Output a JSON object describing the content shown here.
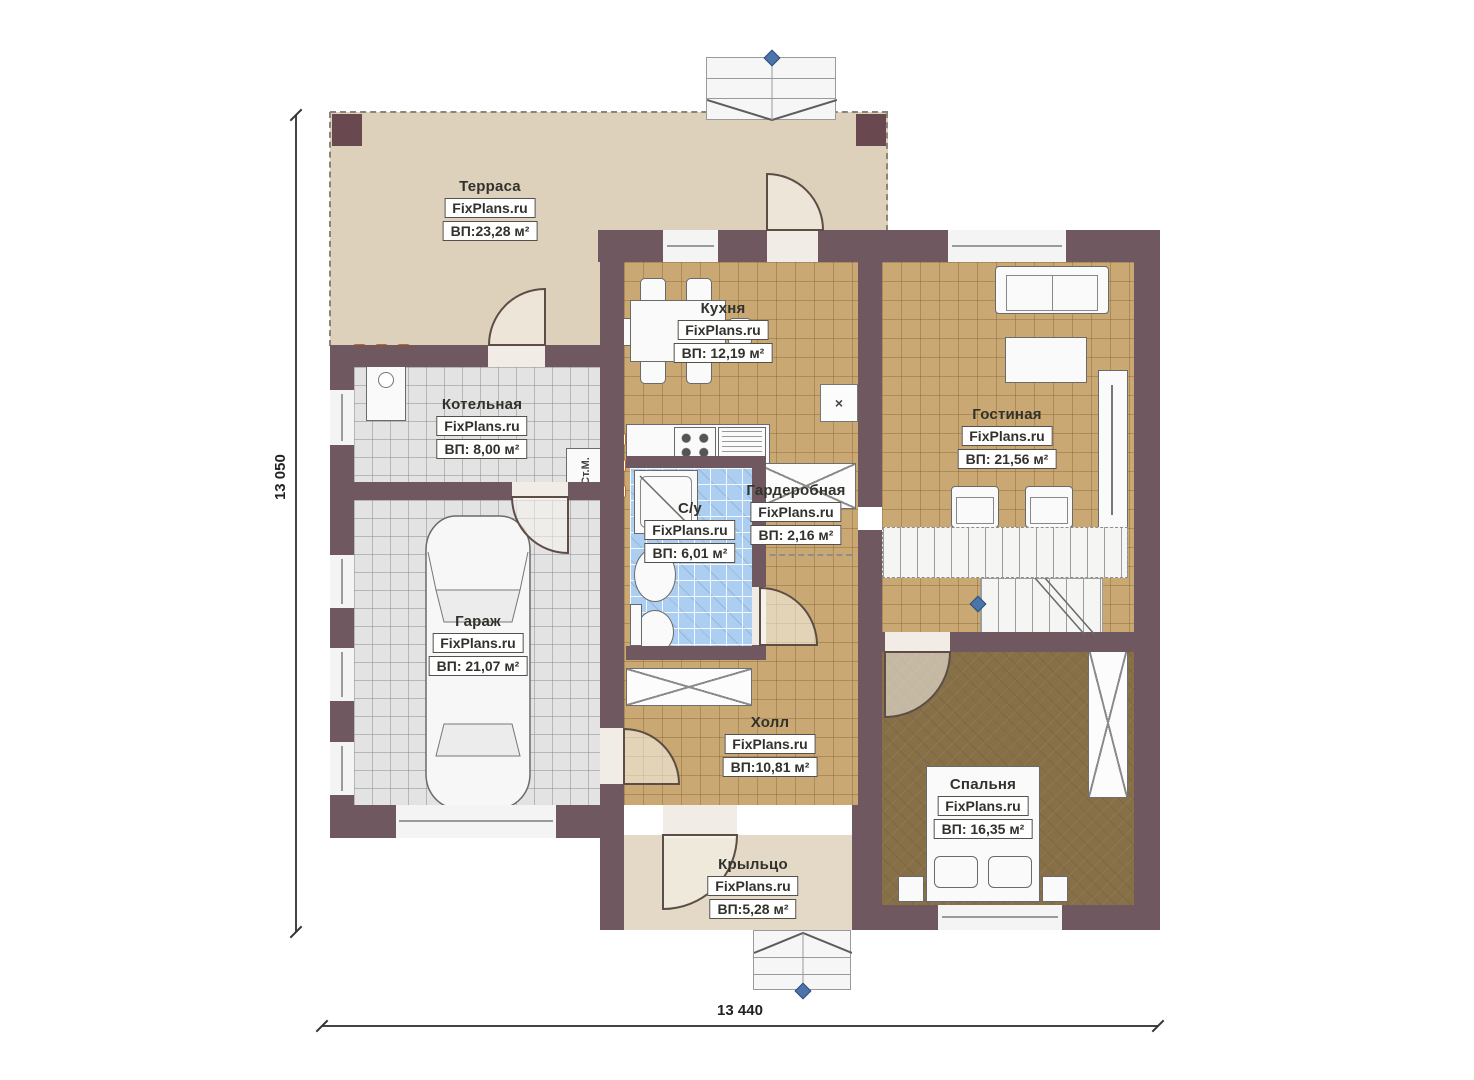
{
  "plan_title": "Floor plan (first floor)",
  "brand_watermark": "FixPlans.ru",
  "dimensions": {
    "left_total": "13 050",
    "bottom_total": "13 440"
  },
  "rooms": [
    {
      "id": "terrace",
      "name": "Терраса",
      "brand": "FixPlans.ru",
      "area": "ВП:23,28 м²"
    },
    {
      "id": "kitchen",
      "name": "Кухня",
      "brand": "FixPlans.ru",
      "area": "ВП: 12,19 м²"
    },
    {
      "id": "boiler",
      "name": "Котельная",
      "brand": "FixPlans.ru",
      "area": "ВП: 8,00 м²"
    },
    {
      "id": "living",
      "name": "Гостиная",
      "brand": "FixPlans.ru",
      "area": "ВП: 21,56 м²"
    },
    {
      "id": "wardrobe",
      "name": "Гардеробная",
      "brand": "FixPlans.ru",
      "area": "ВП: 2,16 м²"
    },
    {
      "id": "bathroom",
      "name": "С/у",
      "brand": "FixPlans.ru",
      "area": "ВП: 6,01 м²"
    },
    {
      "id": "garage",
      "name": "Гараж",
      "brand": "FixPlans.ru",
      "area": "ВП: 21,07 м²"
    },
    {
      "id": "hall",
      "name": "Холл",
      "brand": "FixPlans.ru",
      "area": "ВП:10,81 м²"
    },
    {
      "id": "bedroom",
      "name": "Спальня",
      "brand": "FixPlans.ru",
      "area": "ВП: 16,35 м²"
    },
    {
      "id": "porch",
      "name": "Крыльцо",
      "brand": "FixPlans.ru",
      "area": "ВП:5,28 м²"
    }
  ],
  "annotations": {
    "washing_machine": "Ст.М.",
    "vent_mark": "×"
  },
  "colors": {
    "wall": "#705860",
    "post": "#69494f",
    "terrace_floor": "#ddd1bc",
    "porch_floor": "#e4d9c6",
    "tile_tan": "#c9a873",
    "tile_gray": "#e3e3e3",
    "tile_blue": "#accef0",
    "bedroom_floor": "#877048",
    "radiator_orange": "#f0781e",
    "marker_blue": "#4a74aa"
  }
}
